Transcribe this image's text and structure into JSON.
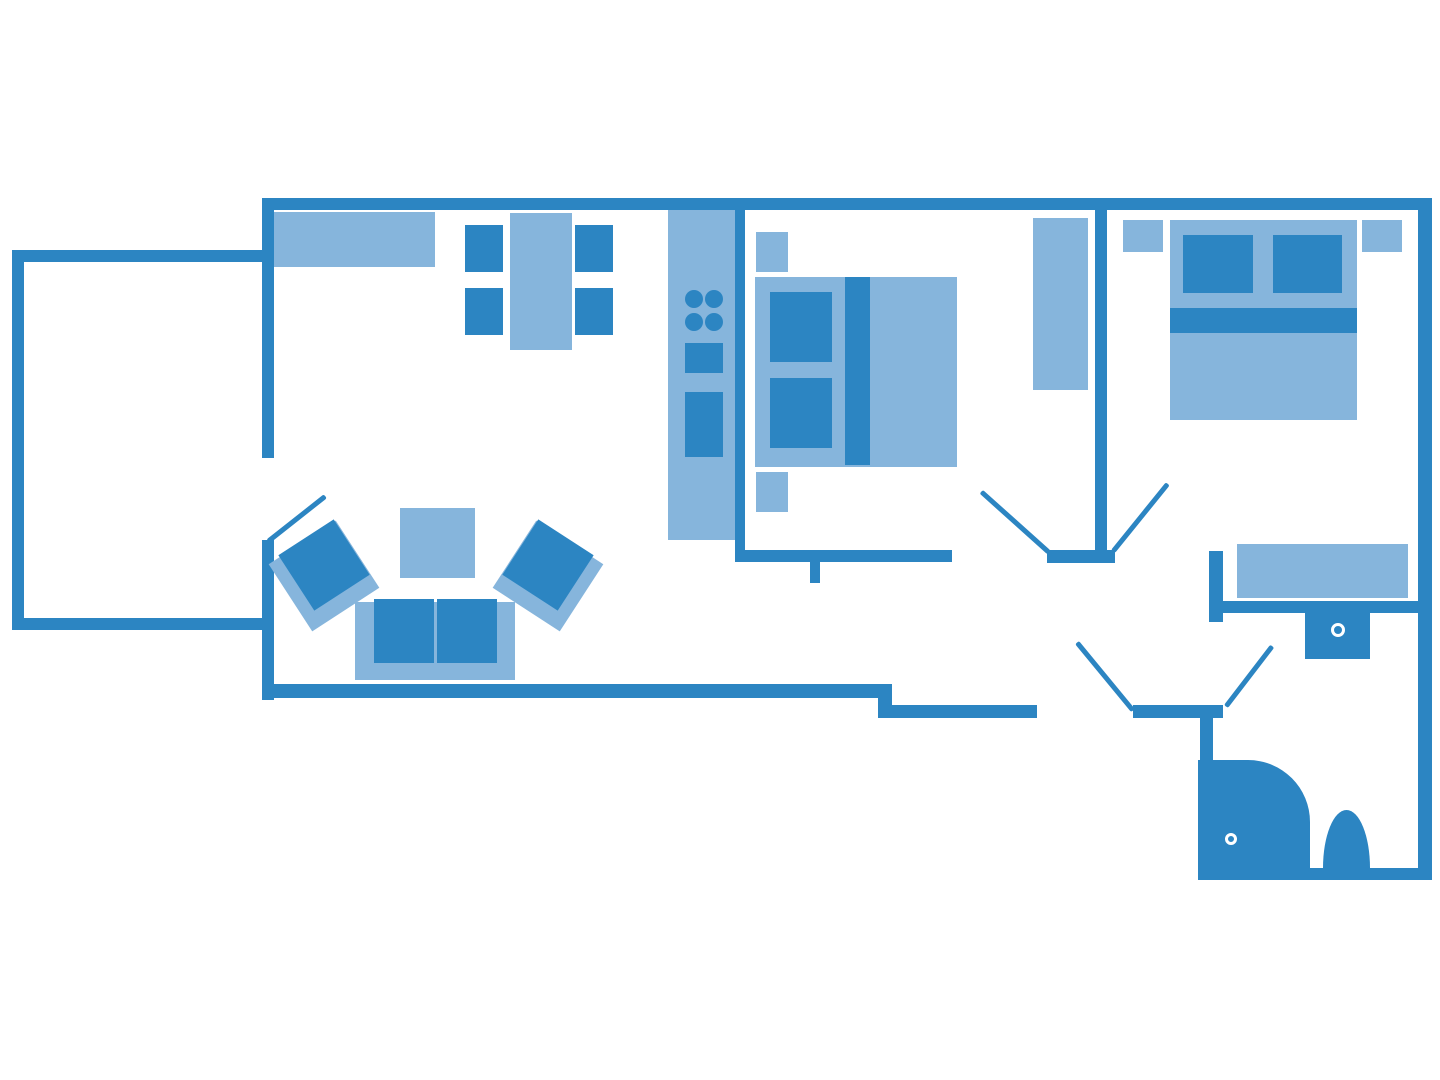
{
  "colors": {
    "background": "#ffffff",
    "wall": "#2c85c2",
    "furniture_dark": "#2c85c2",
    "furniture_light": "#86b5dc",
    "drain": "#ffffff"
  },
  "floor_plan": {
    "canvas": {
      "width": 1440,
      "height": 1080
    },
    "rooms": [
      "balcony",
      "living-room",
      "kitchen",
      "bedroom-middle",
      "bedroom-right",
      "hallway",
      "bathroom"
    ],
    "walls": [
      {
        "name": "top-wall",
        "x": 262,
        "y": 198,
        "w": 1170,
        "h": 12
      },
      {
        "name": "left-wall-upper",
        "x": 262,
        "y": 198,
        "w": 12,
        "h": 260
      },
      {
        "name": "left-wall-lower",
        "x": 262,
        "y": 540,
        "w": 12,
        "h": 160
      },
      {
        "name": "living-room-bottom-wall",
        "x": 262,
        "y": 684,
        "w": 630,
        "h": 14
      },
      {
        "name": "entry-step-wall",
        "x": 878,
        "y": 684,
        "w": 14,
        "h": 34
      },
      {
        "name": "hall-bottom-wall-left",
        "x": 878,
        "y": 705,
        "w": 159,
        "h": 13
      },
      {
        "name": "hall-bottom-wall-right",
        "x": 1133,
        "y": 705,
        "w": 90,
        "h": 13
      },
      {
        "name": "right-wall",
        "x": 1418,
        "y": 198,
        "w": 14,
        "h": 682
      },
      {
        "name": "kitchen-partition-wall",
        "x": 735,
        "y": 208,
        "w": 10,
        "h": 354
      },
      {
        "name": "bedroom-middle-bottom-wall",
        "x": 737,
        "y": 550,
        "w": 215,
        "h": 12
      },
      {
        "name": "bedroom-middle-wall-stub",
        "x": 810,
        "y": 562,
        "w": 10,
        "h": 21
      },
      {
        "name": "bedrooms-partition-wall",
        "x": 1095,
        "y": 210,
        "w": 12,
        "h": 342
      },
      {
        "name": "doorway-separator-wall",
        "x": 1047,
        "y": 550,
        "w": 68,
        "h": 13
      },
      {
        "name": "bathroom-entry-stub-wall",
        "x": 1209,
        "y": 551,
        "w": 14,
        "h": 71
      },
      {
        "name": "bathroom-top-wall",
        "x": 1223,
        "y": 601,
        "w": 195,
        "h": 12
      },
      {
        "name": "bathroom-left-wall",
        "x": 1200,
        "y": 718,
        "w": 13,
        "h": 150
      },
      {
        "name": "bathroom-bottom-wall",
        "x": 1198,
        "y": 868,
        "w": 234,
        "h": 12
      },
      {
        "name": "balcony-top-wall",
        "x": 12,
        "y": 250,
        "w": 250,
        "h": 12
      },
      {
        "name": "balcony-left-wall",
        "x": 12,
        "y": 250,
        "w": 12,
        "h": 380
      },
      {
        "name": "balcony-bottom-wall",
        "x": 12,
        "y": 618,
        "w": 250,
        "h": 12
      }
    ],
    "doors": [
      {
        "name": "balcony-door-leaf",
        "x1": 268,
        "y1": 541,
        "x2": 325,
        "y2": 496
      },
      {
        "name": "bedroom-middle-door-leaf",
        "x1": 1049,
        "y1": 552,
        "x2": 981,
        "y2": 491
      },
      {
        "name": "bedroom-right-door-leaf",
        "x1": 1113,
        "y1": 551,
        "x2": 1168,
        "y2": 483
      },
      {
        "name": "entrance-door-leaf",
        "x1": 1133,
        "y1": 710,
        "x2": 1077,
        "y2": 642
      },
      {
        "name": "bathroom-door-leaf",
        "x1": 1226,
        "y1": 706,
        "x2": 1272,
        "y2": 646
      }
    ],
    "furniture": [
      {
        "name": "sideboard",
        "room": "living-room",
        "shade": "light",
        "shape": "rect",
        "x": 274,
        "y": 212,
        "w": 161,
        "h": 55
      },
      {
        "name": "dining-table",
        "room": "living-room",
        "shade": "light",
        "shape": "rect",
        "x": 510,
        "y": 213,
        "w": 62,
        "h": 137
      },
      {
        "name": "dining-chair-1",
        "room": "living-room",
        "shade": "dark",
        "shape": "rect",
        "x": 465,
        "y": 225,
        "w": 38,
        "h": 47
      },
      {
        "name": "dining-chair-2",
        "room": "living-room",
        "shade": "dark",
        "shape": "rect",
        "x": 575,
        "y": 225,
        "w": 38,
        "h": 47
      },
      {
        "name": "dining-chair-3",
        "room": "living-room",
        "shade": "dark",
        "shape": "rect",
        "x": 465,
        "y": 288,
        "w": 38,
        "h": 47
      },
      {
        "name": "dining-chair-4",
        "room": "living-room",
        "shade": "dark",
        "shape": "rect",
        "x": 575,
        "y": 288,
        "w": 38,
        "h": 47
      },
      {
        "name": "armchair-left-back",
        "room": "living-room",
        "shade": "light",
        "shape": "rect",
        "x": 284,
        "y": 536,
        "w": 80,
        "h": 80,
        "rot": -33
      },
      {
        "name": "armchair-left-seat",
        "room": "living-room",
        "shade": "dark",
        "shape": "rect",
        "x": 291,
        "y": 532,
        "w": 66,
        "h": 66,
        "rot": -33
      },
      {
        "name": "armchair-right-back",
        "room": "living-room",
        "shade": "light",
        "shape": "rect",
        "x": 508,
        "y": 536,
        "w": 80,
        "h": 80,
        "rot": 33
      },
      {
        "name": "armchair-right-seat",
        "room": "living-room",
        "shade": "dark",
        "shape": "rect",
        "x": 515,
        "y": 532,
        "w": 66,
        "h": 66,
        "rot": 33
      },
      {
        "name": "coffee-table",
        "room": "living-room",
        "shade": "light",
        "shape": "rect",
        "x": 400,
        "y": 508,
        "w": 75,
        "h": 70
      },
      {
        "name": "sofa-base",
        "room": "living-room",
        "shade": "light",
        "shape": "rect",
        "x": 355,
        "y": 602,
        "w": 160,
        "h": 78
      },
      {
        "name": "sofa-cushion-left",
        "room": "living-room",
        "shade": "dark",
        "shape": "rect",
        "x": 374,
        "y": 599,
        "w": 60,
        "h": 64
      },
      {
        "name": "sofa-cushion-right",
        "room": "living-room",
        "shade": "dark",
        "shape": "rect",
        "x": 437,
        "y": 599,
        "w": 60,
        "h": 64
      },
      {
        "name": "kitchen-counter",
        "room": "kitchen",
        "shade": "light",
        "shape": "rect",
        "x": 668,
        "y": 210,
        "w": 67,
        "h": 330
      },
      {
        "name": "stove-burner-1",
        "room": "kitchen",
        "shade": "dark",
        "shape": "circle",
        "cx": 694,
        "cy": 299,
        "r": 9
      },
      {
        "name": "stove-burner-2",
        "room": "kitchen",
        "shade": "dark",
        "shape": "circle",
        "cx": 714,
        "cy": 299,
        "r": 9
      },
      {
        "name": "stove-burner-3",
        "room": "kitchen",
        "shade": "dark",
        "shape": "circle",
        "cx": 694,
        "cy": 322,
        "r": 9
      },
      {
        "name": "stove-burner-4",
        "room": "kitchen",
        "shade": "dark",
        "shape": "circle",
        "cx": 714,
        "cy": 322,
        "r": 9
      },
      {
        "name": "kitchen-sink",
        "room": "kitchen",
        "shade": "dark",
        "shape": "rect",
        "x": 685,
        "y": 343,
        "w": 38,
        "h": 30
      },
      {
        "name": "kitchen-appliance",
        "room": "kitchen",
        "shade": "dark",
        "shape": "rect",
        "x": 685,
        "y": 392,
        "w": 38,
        "h": 65
      },
      {
        "name": "bedroom-middle-nightstand-top",
        "room": "bedroom-middle",
        "shade": "light",
        "shape": "rect",
        "x": 756,
        "y": 232,
        "w": 32,
        "h": 40
      },
      {
        "name": "bedroom-middle-bed-base",
        "room": "bedroom-middle",
        "shade": "light",
        "shape": "rect",
        "x": 755,
        "y": 277,
        "w": 202,
        "h": 190
      },
      {
        "name": "bedroom-middle-pillow-top",
        "room": "bedroom-middle",
        "shade": "dark",
        "shape": "rect",
        "x": 770,
        "y": 292,
        "w": 62,
        "h": 70
      },
      {
        "name": "bedroom-middle-pillow-bottom",
        "room": "bedroom-middle",
        "shade": "dark",
        "shape": "rect",
        "x": 770,
        "y": 378,
        "w": 62,
        "h": 70
      },
      {
        "name": "bedroom-middle-duvet-stripe",
        "room": "bedroom-middle",
        "shade": "dark",
        "shape": "rect",
        "x": 845,
        "y": 277,
        "w": 25,
        "h": 188
      },
      {
        "name": "bedroom-middle-nightstand-bottom",
        "room": "bedroom-middle",
        "shade": "light",
        "shape": "rect",
        "x": 756,
        "y": 472,
        "w": 32,
        "h": 40
      },
      {
        "name": "bedroom-middle-wardrobe",
        "room": "bedroom-middle",
        "shade": "light",
        "shape": "rect",
        "x": 1033,
        "y": 218,
        "w": 55,
        "h": 172
      },
      {
        "name": "bedroom-right-nightstand-left",
        "room": "bedroom-right",
        "shade": "light",
        "shape": "rect",
        "x": 1123,
        "y": 220,
        "w": 40,
        "h": 32
      },
      {
        "name": "bedroom-right-nightstand-right",
        "room": "bedroom-right",
        "shade": "light",
        "shape": "rect",
        "x": 1362,
        "y": 220,
        "w": 40,
        "h": 32
      },
      {
        "name": "bedroom-right-bed-base",
        "room": "bedroom-right",
        "shade": "light",
        "shape": "rect",
        "x": 1170,
        "y": 220,
        "w": 187,
        "h": 200
      },
      {
        "name": "bedroom-right-pillow-left",
        "room": "bedroom-right",
        "shade": "dark",
        "shape": "rect",
        "x": 1183,
        "y": 235,
        "w": 70,
        "h": 58
      },
      {
        "name": "bedroom-right-pillow-right",
        "room": "bedroom-right",
        "shade": "dark",
        "shape": "rect",
        "x": 1273,
        "y": 235,
        "w": 69,
        "h": 58
      },
      {
        "name": "bedroom-right-duvet-stripe",
        "room": "bedroom-right",
        "shade": "dark",
        "shape": "rect",
        "x": 1170,
        "y": 308,
        "w": 187,
        "h": 25
      },
      {
        "name": "bedroom-right-dresser",
        "room": "bedroom-right",
        "shade": "light",
        "shape": "rect",
        "x": 1237,
        "y": 544,
        "w": 171,
        "h": 54
      },
      {
        "name": "bathroom-washbasin",
        "room": "bathroom",
        "shade": "dark",
        "shape": "rect",
        "x": 1305,
        "y": 613,
        "w": 65,
        "h": 46
      },
      {
        "name": "bathroom-washbasin-drain",
        "room": "bathroom",
        "shape": "ring",
        "cx": 1338,
        "cy": 630,
        "r": 7
      },
      {
        "name": "shower",
        "room": "bathroom",
        "shade": "dark",
        "shape": "rect",
        "x": 1198,
        "y": 760,
        "w": 112,
        "h": 108,
        "radius": "0 62px 0 0"
      },
      {
        "name": "shower-drain",
        "room": "bathroom",
        "shape": "ring",
        "cx": 1231,
        "cy": 839,
        "r": 6
      },
      {
        "name": "toilet",
        "room": "bathroom",
        "shade": "dark",
        "shape": "rect",
        "x": 1323,
        "y": 810,
        "w": 47,
        "h": 58,
        "radius": "50% 50% 0 0 / 100% 100% 0 0"
      }
    ]
  }
}
